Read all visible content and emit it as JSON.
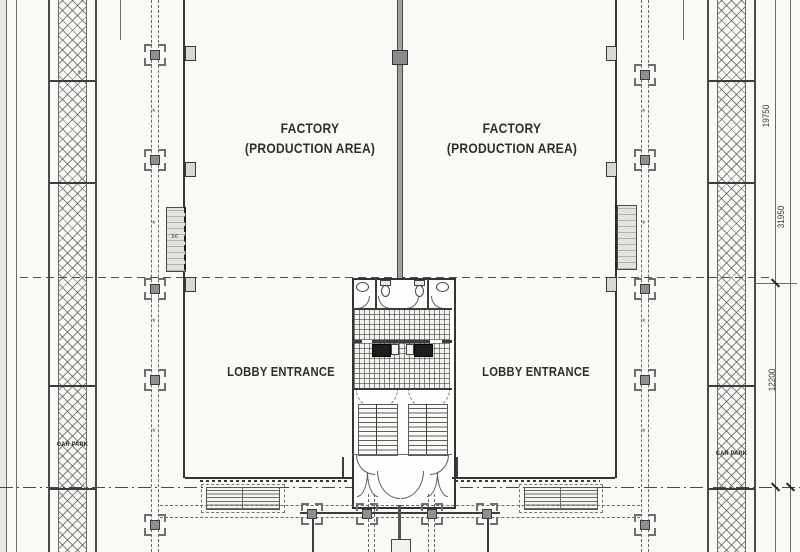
{
  "plan": {
    "labels": {
      "factory_line1": "FACTORY",
      "factory_line2": "(PRODUCTION AREA)",
      "lobby": "LOBBY ENTRANCE",
      "car_park": "CAR PARK"
    },
    "dimensions": {
      "right_upper": "19750",
      "right_total": "31950",
      "right_lower": "12200"
    },
    "bay_numbers": {
      "left_upper": "6",
      "left_lower": "7"
    },
    "roller_door_label": "100"
  }
}
